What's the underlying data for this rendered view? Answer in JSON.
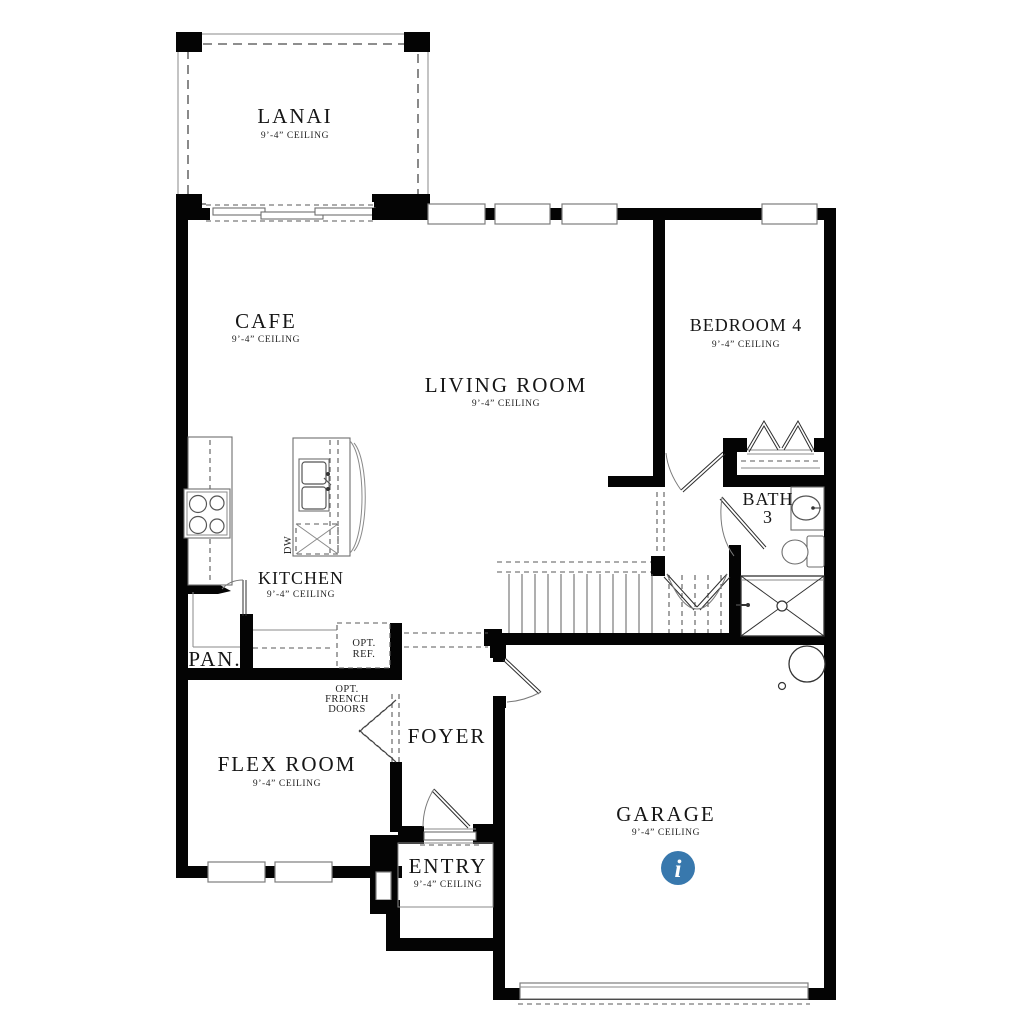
{
  "plan_title": "floor-plan-first-floor",
  "rooms": {
    "lanai": {
      "name": "LANAI",
      "ceiling": "9’-4” CEILING"
    },
    "cafe": {
      "name": "CAFE",
      "ceiling": "9’-4” CEILING"
    },
    "living_room": {
      "name": "LIVING ROOM",
      "ceiling": "9’-4” CEILING"
    },
    "bedroom4": {
      "name": "BEDROOM 4",
      "ceiling": "9’-4” CEILING"
    },
    "bath3": {
      "name_line1": "BATH",
      "name_line2": "3"
    },
    "kitchen": {
      "name": "KITCHEN",
      "ceiling": "9’-4” CEILING"
    },
    "pantry": {
      "name": "PAN."
    },
    "flex_room": {
      "name": "FLEX ROOM",
      "ceiling": "9’-4” CEILING"
    },
    "foyer": {
      "name": "FOYER"
    },
    "entry": {
      "name": "ENTRY",
      "ceiling": "9’-4” CEILING"
    },
    "garage": {
      "name": "GARAGE",
      "ceiling": "9’-4” CEILING"
    }
  },
  "annotations": {
    "opt_ref": {
      "line1": "OPT.",
      "line2": "REF."
    },
    "opt_french_doors": {
      "line1": "OPT.",
      "line2": "FRENCH",
      "line3": "DOORS"
    },
    "dishwasher": "DW"
  },
  "info_button": {
    "glyph": "i",
    "color": "#3878AD"
  }
}
